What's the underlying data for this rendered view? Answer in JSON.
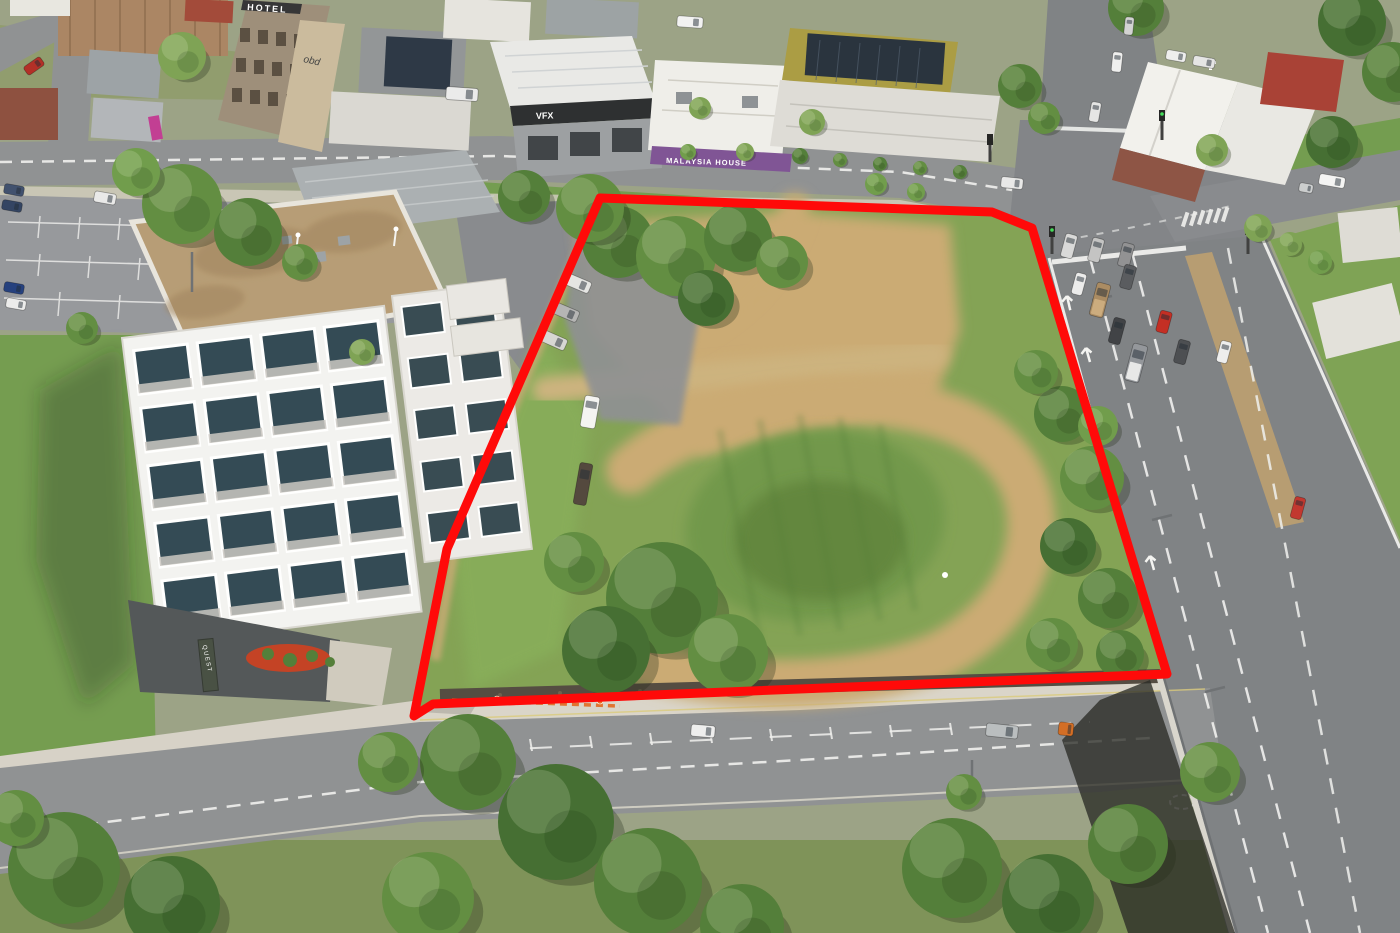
{
  "meta": {
    "scene_type": "aerial-drone-photograph",
    "subject": "vacant development site outlined in red beside Quest apartment building, busy highway and intersection"
  },
  "signs": {
    "quest_roof": "QUEST",
    "quest_entrance": "QUEST",
    "hotel": "HOTEL",
    "vfx": "VFX",
    "malaysia_house": "MALAYSIA HOUSE"
  },
  "boundary": {
    "color": "#ff0000",
    "stroke_width": 9,
    "points": "600,198 992,212 1032,228 1167,674 433,704 414,716 447,549"
  },
  "palette": {
    "grass": "#7fa050",
    "bright_grass": "#84ab55",
    "dirt": "#c9a86f",
    "road": "#8c8e90",
    "highway": "#7b7e82",
    "concrete": "#d6d1c6",
    "roof_tan": "#b59a72",
    "building_white": "#f3f3f1",
    "boundary_red": "#ff0000",
    "tree_tones": [
      "#3f6a2c",
      "#4e7a33",
      "#5d8a3c",
      "#6c9a46",
      "#7aa050"
    ]
  },
  "scene": {
    "vehicles": [
      {
        "x": 1069,
        "y": 246,
        "l": 24,
        "w": 12,
        "rot": 15,
        "c": "#d8d8d8"
      },
      {
        "x": 1096,
        "y": 250,
        "l": 24,
        "w": 12,
        "rot": 15,
        "c": "#c2c2c2"
      },
      {
        "x": 1126,
        "y": 255,
        "l": 24,
        "w": 12,
        "rot": 15,
        "c": "#8e8e90"
      },
      {
        "x": 1079,
        "y": 284,
        "l": 22,
        "w": 11,
        "rot": 15,
        "c": "#ececec"
      },
      {
        "x": 1128,
        "y": 277,
        "l": 24,
        "w": 12,
        "rot": 15,
        "c": "#54565a"
      },
      {
        "x": 1100,
        "y": 300,
        "l": 34,
        "w": 14,
        "rot": 15,
        "c": "#a8885e",
        "accent": "#caa97a"
      },
      {
        "x": 1117,
        "y": 331,
        "l": 26,
        "w": 12,
        "rot": 15,
        "c": "#3a3c40"
      },
      {
        "x": 1164,
        "y": 322,
        "l": 22,
        "w": 12,
        "rot": 15,
        "c": "#c2271d"
      },
      {
        "x": 1136,
        "y": 363,
        "l": 38,
        "w": 15,
        "rot": 15,
        "c": "#909398",
        "accent": "#e8e8e8"
      },
      {
        "x": 1182,
        "y": 352,
        "l": 24,
        "w": 12,
        "rot": 15,
        "c": "#46484c"
      },
      {
        "x": 1224,
        "y": 352,
        "l": 22,
        "w": 11,
        "rot": 15,
        "c": "#eeeeee"
      },
      {
        "x": 1298,
        "y": 508,
        "l": 22,
        "w": 11,
        "rot": 15,
        "c": "#c03028"
      },
      {
        "x": 1095,
        "y": 112,
        "l": 20,
        "w": 10,
        "rot": 10,
        "c": "#e4e4e4"
      },
      {
        "x": 1117,
        "y": 62,
        "l": 20,
        "w": 10,
        "rot": 6,
        "c": "#efefef"
      },
      {
        "x": 1129,
        "y": 26,
        "l": 18,
        "w": 9,
        "rot": 6,
        "c": "#d2d2d2"
      },
      {
        "x": 1332,
        "y": 181,
        "l": 26,
        "w": 11,
        "rot": 100,
        "c": "#f4f4f4"
      },
      {
        "x": 1306,
        "y": 188,
        "l": 14,
        "w": 9,
        "rot": 100,
        "c": "#caccce"
      },
      {
        "x": 1012,
        "y": 183,
        "l": 22,
        "w": 11,
        "rot": 96,
        "c": "#e8e8e8"
      },
      {
        "x": 462,
        "y": 94,
        "l": 32,
        "w": 13,
        "rot": 94,
        "c": "#ebebeb"
      },
      {
        "x": 690,
        "y": 22,
        "l": 26,
        "w": 11,
        "rot": 94,
        "c": "#f2f2f2"
      },
      {
        "x": 34,
        "y": 66,
        "l": 20,
        "w": 10,
        "rot": 55,
        "c": "#b02820"
      },
      {
        "x": 105,
        "y": 198,
        "l": 22,
        "w": 11,
        "rot": 100,
        "c": "#e9e9e9"
      },
      {
        "x": 14,
        "y": 190,
        "l": 20,
        "w": 10,
        "rot": 100,
        "c": "#3a4a6a"
      },
      {
        "x": 12,
        "y": 206,
        "l": 20,
        "w": 10,
        "rot": 100,
        "c": "#2c3e5e"
      },
      {
        "x": 14,
        "y": 288,
        "l": 20,
        "w": 10,
        "rot": 100,
        "c": "#1e3a7a"
      },
      {
        "x": 16,
        "y": 304,
        "l": 20,
        "w": 10,
        "rot": 100,
        "c": "#ececec"
      },
      {
        "x": 703,
        "y": 731,
        "l": 24,
        "w": 12,
        "rot": 95,
        "c": "#eeeeee"
      },
      {
        "x": 1002,
        "y": 731,
        "l": 32,
        "w": 13,
        "rot": 96,
        "c": "#b8bcbe"
      },
      {
        "x": 1066,
        "y": 729,
        "l": 15,
        "w": 13,
        "rot": 96,
        "c": "#d2691e"
      },
      {
        "x": 590,
        "y": 412,
        "l": 32,
        "w": 15,
        "rot": 10,
        "c": "#f4f4f2"
      },
      {
        "x": 583,
        "y": 484,
        "l": 42,
        "w": 13,
        "rot": 10,
        "c": "#4e4238"
      },
      {
        "x": 577,
        "y": 283,
        "l": 28,
        "w": 12,
        "rot": 113,
        "c": "#e4e4e2"
      },
      {
        "x": 565,
        "y": 312,
        "l": 28,
        "w": 12,
        "rot": 113,
        "c": "#b2b2b2"
      },
      {
        "x": 553,
        "y": 340,
        "l": 28,
        "w": 12,
        "rot": 114,
        "c": "#d6d6d2"
      },
      {
        "x": 1176,
        "y": 56,
        "l": 20,
        "w": 10,
        "rot": 100,
        "c": "#eeeeee"
      },
      {
        "x": 1204,
        "y": 62,
        "l": 22,
        "w": 10,
        "rot": 100,
        "c": "#e4e4e4"
      }
    ],
    "trees": [
      {
        "x": 618,
        "y": 242,
        "r": 36,
        "tone": 1
      },
      {
        "x": 676,
        "y": 256,
        "r": 40,
        "tone": 2
      },
      {
        "x": 738,
        "y": 238,
        "r": 34,
        "tone": 1
      },
      {
        "x": 782,
        "y": 262,
        "r": 26,
        "tone": 2
      },
      {
        "x": 706,
        "y": 298,
        "r": 28,
        "tone": 0
      },
      {
        "x": 524,
        "y": 196,
        "r": 26,
        "tone": 1
      },
      {
        "x": 590,
        "y": 208,
        "r": 34,
        "tone": 2
      },
      {
        "x": 182,
        "y": 204,
        "r": 40,
        "tone": 2
      },
      {
        "x": 248,
        "y": 232,
        "r": 34,
        "tone": 1
      },
      {
        "x": 136,
        "y": 172,
        "r": 24,
        "tone": 3
      },
      {
        "x": 300,
        "y": 262,
        "r": 18,
        "tone": 2
      },
      {
        "x": 82,
        "y": 328,
        "r": 16,
        "tone": 2
      },
      {
        "x": 182,
        "y": 56,
        "r": 24,
        "tone": 4
      },
      {
        "x": 876,
        "y": 184,
        "r": 11,
        "tone": 3
      },
      {
        "x": 916,
        "y": 192,
        "r": 9,
        "tone": 3
      },
      {
        "x": 362,
        "y": 352,
        "r": 13,
        "tone": 4
      },
      {
        "x": 700,
        "y": 108,
        "r": 11,
        "tone": 4
      },
      {
        "x": 812,
        "y": 122,
        "r": 13,
        "tone": 4
      },
      {
        "x": 745,
        "y": 152,
        "r": 9,
        "tone": 4
      },
      {
        "x": 688,
        "y": 152,
        "r": 8,
        "tone": 3
      },
      {
        "x": 662,
        "y": 598,
        "r": 56,
        "tone": 1
      },
      {
        "x": 606,
        "y": 650,
        "r": 44,
        "tone": 0
      },
      {
        "x": 728,
        "y": 654,
        "r": 40,
        "tone": 2
      },
      {
        "x": 574,
        "y": 562,
        "r": 30,
        "tone": 2
      },
      {
        "x": 1062,
        "y": 414,
        "r": 28,
        "tone": 1
      },
      {
        "x": 1092,
        "y": 478,
        "r": 32,
        "tone": 2
      },
      {
        "x": 1068,
        "y": 546,
        "r": 28,
        "tone": 0
      },
      {
        "x": 1108,
        "y": 598,
        "r": 30,
        "tone": 1
      },
      {
        "x": 1052,
        "y": 644,
        "r": 26,
        "tone": 2
      },
      {
        "x": 1120,
        "y": 654,
        "r": 24,
        "tone": 1
      },
      {
        "x": 1036,
        "y": 372,
        "r": 22,
        "tone": 2
      },
      {
        "x": 1098,
        "y": 426,
        "r": 20,
        "tone": 3
      },
      {
        "x": 1020,
        "y": 86,
        "r": 22,
        "tone": 1
      },
      {
        "x": 1044,
        "y": 118,
        "r": 16,
        "tone": 2
      },
      {
        "x": 1352,
        "y": 22,
        "r": 34,
        "tone": 0
      },
      {
        "x": 1392,
        "y": 72,
        "r": 30,
        "tone": 1
      },
      {
        "x": 1332,
        "y": 142,
        "r": 26,
        "tone": 0
      },
      {
        "x": 1136,
        "y": 8,
        "r": 28,
        "tone": 1
      },
      {
        "x": 1212,
        "y": 150,
        "r": 16,
        "tone": 4
      },
      {
        "x": 1258,
        "y": 228,
        "r": 14,
        "tone": 4
      },
      {
        "x": 1290,
        "y": 244,
        "r": 12,
        "tone": 4
      },
      {
        "x": 1320,
        "y": 262,
        "r": 12,
        "tone": 3
      },
      {
        "x": 468,
        "y": 762,
        "r": 48,
        "tone": 1
      },
      {
        "x": 556,
        "y": 822,
        "r": 58,
        "tone": 0
      },
      {
        "x": 648,
        "y": 882,
        "r": 54,
        "tone": 1
      },
      {
        "x": 428,
        "y": 898,
        "r": 46,
        "tone": 2
      },
      {
        "x": 742,
        "y": 926,
        "r": 42,
        "tone": 1
      },
      {
        "x": 388,
        "y": 762,
        "r": 30,
        "tone": 2
      },
      {
        "x": 952,
        "y": 868,
        "r": 50,
        "tone": 1
      },
      {
        "x": 1048,
        "y": 900,
        "r": 46,
        "tone": 0
      },
      {
        "x": 1128,
        "y": 844,
        "r": 40,
        "tone": 1
      },
      {
        "x": 1210,
        "y": 772,
        "r": 30,
        "tone": 2
      },
      {
        "x": 64,
        "y": 868,
        "r": 56,
        "tone": 1
      },
      {
        "x": 172,
        "y": 904,
        "r": 48,
        "tone": 0
      },
      {
        "x": 16,
        "y": 818,
        "r": 28,
        "tone": 2
      },
      {
        "x": 964,
        "y": 792,
        "r": 18,
        "tone": 2
      },
      {
        "x": 800,
        "y": 156,
        "r": 8,
        "tone": 1
      },
      {
        "x": 840,
        "y": 160,
        "r": 7,
        "tone": 2
      },
      {
        "x": 880,
        "y": 164,
        "r": 7,
        "tone": 1
      },
      {
        "x": 920,
        "y": 168,
        "r": 7,
        "tone": 2
      },
      {
        "x": 960,
        "y": 172,
        "r": 7,
        "tone": 1
      }
    ],
    "workers": [
      {
        "x": 497,
        "y": 699
      },
      {
        "x": 516,
        "y": 702
      },
      {
        "x": 543,
        "y": 700
      },
      {
        "x": 571,
        "y": 698
      },
      {
        "x": 600,
        "y": 701
      }
    ]
  }
}
